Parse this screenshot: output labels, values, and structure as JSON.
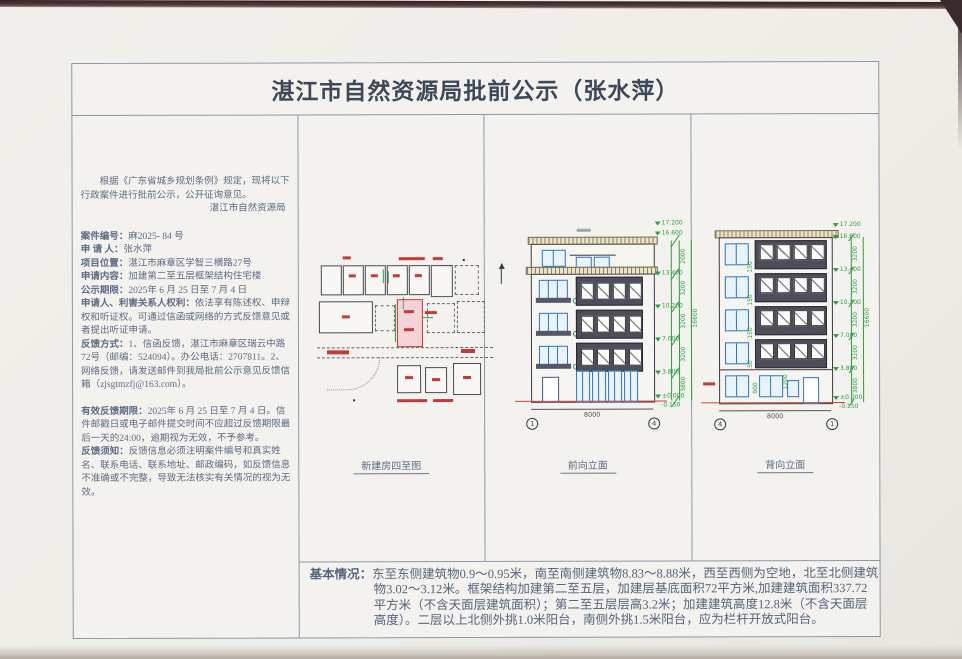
{
  "page": {
    "title": "湛江市自然资源局批前公示（张水萍）"
  },
  "notice": {
    "intro": "根据《广东省城乡规划条例》规定，现将以下行政案件进行批前公示，公开征询意见。",
    "agency": "湛江市自然资源局",
    "fields": [
      {
        "label": "案件编号：",
        "text": "麻2025- 84 号"
      },
      {
        "label": "申 请 人：",
        "text": "张水萍"
      },
      {
        "label": "项目位置：",
        "text": "湛江市麻章区学智三横路27号"
      },
      {
        "label": "申请内容：",
        "text": "加建第二至五层框架结构住宅楼"
      },
      {
        "label": "公示期限：",
        "text": "2025年 6 月 25 日至  7 月 4 日"
      },
      {
        "label": "申请人、利害关系人权利：",
        "text": "依法享有陈述权、申辩权和听证权。可通过信函或网络的方式反馈意见或者提出听证申请。"
      },
      {
        "label": "反馈方式：",
        "text": "1、信函反馈，湛江市麻章区瑞云中路72号（邮编：524094）。办公电话：2707811。2、网络反馈，请发送邮件到我局批前公示意见反馈信箱（zjsgtmzfj@163.com）。"
      },
      {
        "label": "有效反馈期限：",
        "text": "2025年 6 月 25 日至 7 月 4 日。信件邮戳日或电子邮件提交时间不应超过反馈期限最后一天的24:00，逾期视为无效，不予参考。"
      },
      {
        "label": "反馈须知：",
        "text": "反馈信息必须注明案件编号和真实姓名、联系电话、联系地址、邮政编码，如反馈信息不准确或不完整，导致无法核实有关情况的视为无效。"
      }
    ]
  },
  "panels": {
    "site_plan_caption": "新建房四至图",
    "front_caption": "前向立面",
    "back_caption": "背向立面"
  },
  "front_elev": {
    "width_dim": "8000",
    "overall_dim": "16600",
    "grid_left": "1",
    "grid_right": "4",
    "floor_dims": [
      "2000",
      "3200",
      "3200",
      "3200",
      "3800"
    ],
    "levels": [
      "17.200",
      "16.600",
      "13.400",
      "10.200",
      "7.000",
      "3.800",
      "±0.000",
      "-0.150"
    ]
  },
  "back_elev": {
    "width_dim": "8000",
    "overall_dim": "16600",
    "grid_left": "4",
    "grid_right": "1",
    "floor_dims": [
      "3200",
      "3200",
      "3200",
      "3200",
      "3800"
    ],
    "levels": [
      "17.200",
      "16.600",
      "13.400",
      "10.200",
      "7.000",
      "3.800",
      "±0.000",
      "-0.150"
    ],
    "sill_dim": "150",
    "ground_dims": [
      "900",
      "1200"
    ]
  },
  "basic_info": {
    "label": "基本情况：",
    "text": "东至东侧建筑物0.9～0.95米，南至南侧建筑物8.83～8.88米，西至西侧为空地，北至北侧建筑物3.02～3.12米。框架结构加建第二至五层，加建层基底面积72平方米,加建建筑面积337.72平方米（不含天面层建筑面积）；第二至五层层高3.2米；加建建筑高度12.8米（不含天面层高度）。二层以上北侧外挑1.0米阳台，南侧外挑1.5米阳台，应为栏杆开放式阳台。"
  },
  "colors": {
    "dim_green": "#2e9e44",
    "window_blue": "#2f76b5",
    "panel_dark": "#4e4e5a",
    "highlight_red": "#c23a3a",
    "ink_blue_gray": "#5d6b84",
    "table_line": "#8d97a6"
  }
}
